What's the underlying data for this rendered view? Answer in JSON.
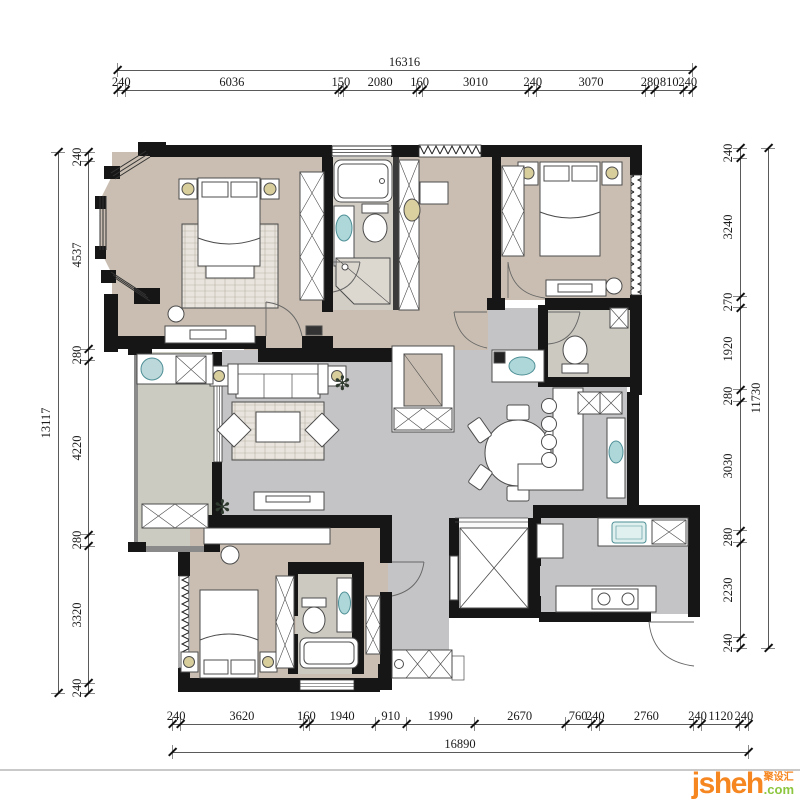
{
  "dimensions": {
    "top": {
      "total": "16316",
      "segments": [
        "240",
        "6036",
        "150",
        "2080",
        "160",
        "3010",
        "240",
        "3070",
        "280",
        "810",
        "240"
      ]
    },
    "bottom": {
      "total": "16890",
      "segments": [
        "240",
        "3620",
        "160",
        "1940",
        "910",
        "1990",
        "2670",
        "760",
        "240",
        "2760",
        "240",
        "1120",
        "240"
      ]
    },
    "left": {
      "total": "13117",
      "segments": [
        "240",
        "4537",
        "280",
        "4220",
        "280",
        "3320",
        "240"
      ]
    },
    "right": {
      "total": "11730",
      "segments": [
        "240",
        "3240",
        "270",
        "1920",
        "280",
        "3030",
        "280",
        "2230",
        "240"
      ]
    }
  },
  "watermark": {
    "brand": "jsheh",
    "cjk": "聚设汇",
    "suffix": ".com"
  },
  "icons": {
    "plant": "✻"
  },
  "colors": {
    "wall": "#161616",
    "floor_bedroom": "#c9beb1",
    "floor_bath": "#d2cec6",
    "floor_living": "#c4c3c5",
    "floor_balcony": "#cbcbc1",
    "fixture_teal": "#aed7d9",
    "lamp_yellow": "#d8ce9c",
    "watermark_orange": "#f6861f",
    "watermark_green": "#8cc63e"
  }
}
